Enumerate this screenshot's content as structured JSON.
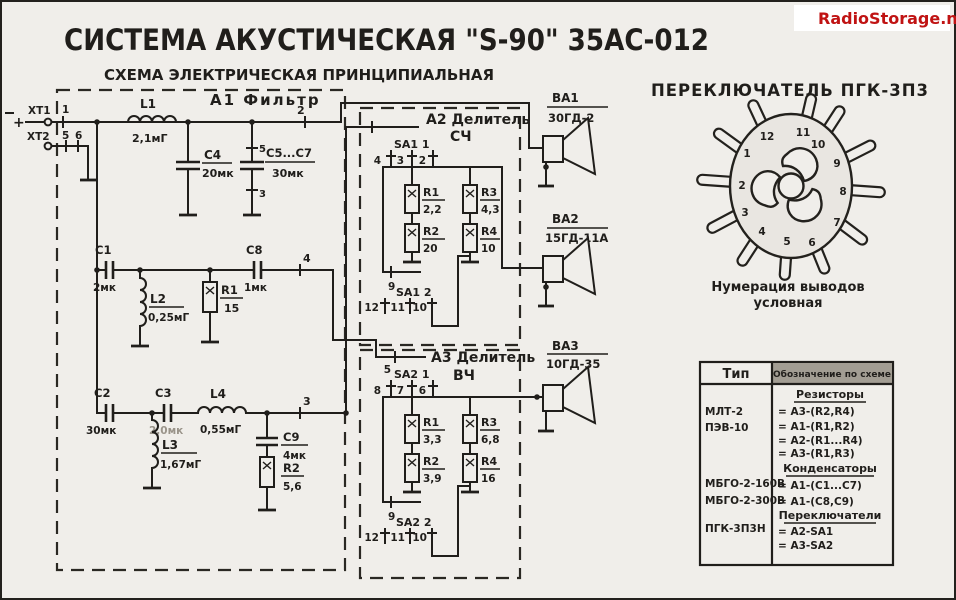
{
  "page": {
    "title": "СИСТЕМА АКУСТИЧЕСКАЯ \"S-90\" 35АС-012",
    "subtitle": "СХЕМА ЭЛЕКТРИЧЕСКАЯ ПРИНЦИПИАЛЬНАЯ",
    "watermark": "RadioStorage.net"
  },
  "colors": {
    "paper": "#f0eeea",
    "ink": "#201e1b",
    "watermark_red": "#c01313",
    "table_header_shade": "#a29d93"
  },
  "blocks": {
    "a1": "А1 Фильтр",
    "a2_title": "А2 Делитель",
    "a2_sub": "СЧ",
    "a3_title": "А3 Делитель",
    "a3_sub": "ВЧ"
  },
  "input": {
    "plus": "+",
    "xt1": "XT1",
    "xt1_pin": "1",
    "xt2": "XT2",
    "xt2_pin5": "5",
    "xt2_pin6": "6"
  },
  "a1": {
    "l1": {
      "n": "L1",
      "v": "2,1мГ"
    },
    "c4": {
      "n": "С4",
      "v": "20мк"
    },
    "c5c7": {
      "n": "С5...С7",
      "v": "30мк",
      "p5": "5",
      "p3": "3"
    },
    "c1": {
      "n": "С1",
      "v": "2мк"
    },
    "l2": {
      "n": "L2",
      "v": "0,25мГ"
    },
    "r1": {
      "n": "R1",
      "v": "15"
    },
    "c8": {
      "n": "С8",
      "v": "1мк"
    },
    "c2": {
      "n": "С2",
      "v": "30мк"
    },
    "c3": {
      "n": "С3",
      "v": "2,0мк"
    },
    "l4": {
      "n": "L4",
      "v": "0,55мГ"
    },
    "l3": {
      "n": "L3",
      "v": "1,67мГ"
    },
    "c9": {
      "n": "С9",
      "v": "4мк"
    },
    "r2": {
      "n": "R2",
      "v": "5,6"
    },
    "n2": "2",
    "n3": "3",
    "n4": "4"
  },
  "a2": {
    "switch1": "SA1 1",
    "switch2": "SA1 2",
    "pin9": "9",
    "pins_top": [
      "4",
      "3",
      "2"
    ],
    "pins_bottom": [
      "12",
      "11",
      "10"
    ],
    "r1": {
      "n": "R1",
      "v": "2,2"
    },
    "r3": {
      "n": "R3",
      "v": "4,3"
    },
    "r2": {
      "n": "R2",
      "v": "20"
    },
    "r4": {
      "n": "R4",
      "v": "10"
    }
  },
  "a3": {
    "pin_in": "5",
    "switch1": "SA2 1",
    "switch2": "SA2 2",
    "pin9": "9",
    "pins_top": [
      "8",
      "7",
      "6"
    ],
    "pins_bottom": [
      "12",
      "11",
      "10"
    ],
    "r1": {
      "n": "R1",
      "v": "3,3"
    },
    "r3": {
      "n": "R3",
      "v": "6,8"
    },
    "r2": {
      "n": "R2",
      "v": "3,9"
    },
    "r4": {
      "n": "R4",
      "v": "16"
    }
  },
  "speakers": {
    "ba1": {
      "ref": "ВА1",
      "type": "30ГД-2"
    },
    "ba2": {
      "ref": "ВА2",
      "type": "15ГД-11А"
    },
    "ba3": {
      "ref": "ВА3",
      "type": "10ГД-35"
    }
  },
  "rotary": {
    "title": "ПЕРЕКЛЮЧАТЕЛЬ ПГК-3П3",
    "caption1": "Нумерация выводов",
    "caption2": "условная",
    "pins": [
      "1",
      "2",
      "3",
      "4",
      "5",
      "6",
      "7",
      "8",
      "9",
      "10",
      "11",
      "12"
    ]
  },
  "table": {
    "col1_header": "Тип",
    "col2_header": "Обозначение по схеме",
    "types": [
      "МЛТ-2",
      "ПЭВ-10",
      "МБГО-2-160В",
      "МБГО-2-300В",
      "ПГК-3П3Н"
    ],
    "sections": [
      {
        "title": "Резисторы",
        "items": [
          "= А3-(R2,R4)",
          "= А1-(R1,R2)",
          "= А2-(R1...R4)",
          "= А3-(R1,R3)"
        ]
      },
      {
        "title": "Конденсаторы",
        "items": [
          "= А1-(С1...С7)",
          "= А1-(С8,С9)"
        ]
      },
      {
        "title": "Переключатели",
        "items": [
          "= А2-SA1",
          "= А3-SA2"
        ]
      }
    ]
  }
}
